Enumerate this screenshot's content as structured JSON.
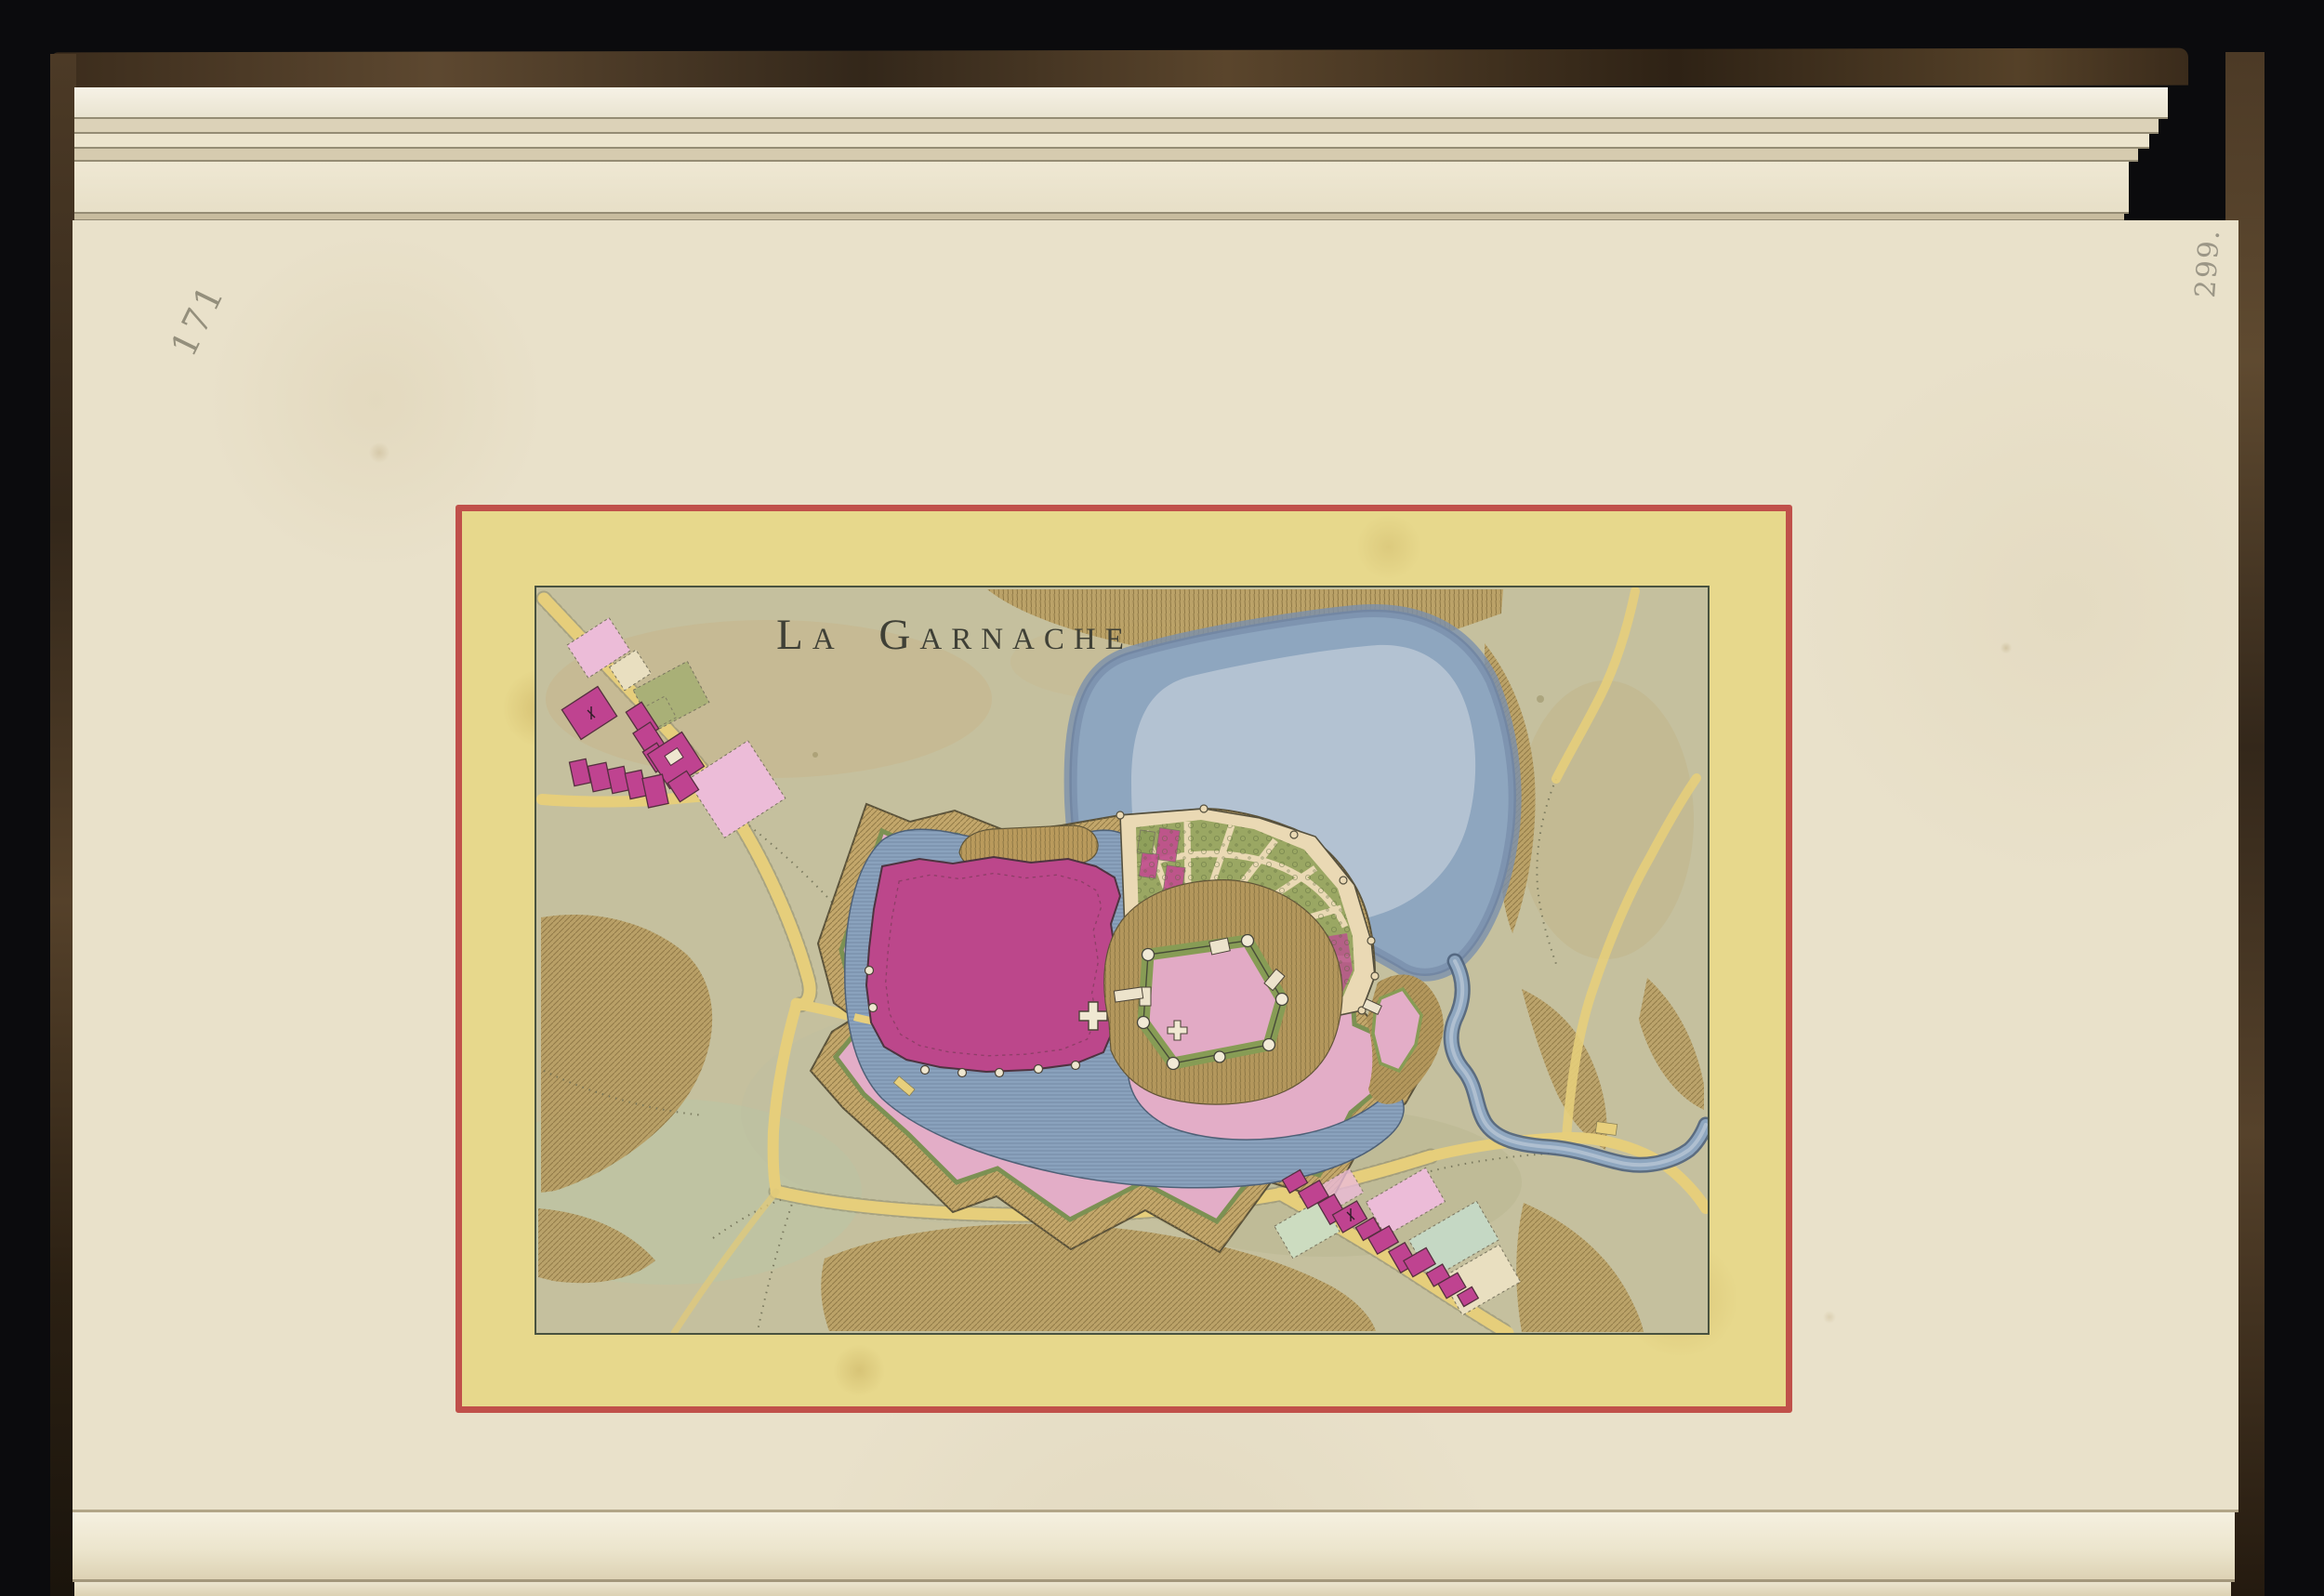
{
  "book": {
    "pencil_page_number": "171",
    "pencil_edge_number": "299."
  },
  "map_plate": {
    "title": "La Garnache",
    "features": {
      "lake": "pond north-east of the fortress",
      "stream": "river leaving the pond toward the right edge",
      "fortified_town": "star-shaped bastioned enceinte with magenta town block and church cross",
      "castle": "pentagonal castle with corner towers and cross",
      "garden": "fan-shaped terraced parterre garden",
      "villages": "hamlets along roads at upper-left and lower-right"
    },
    "colors": {
      "backdrop": "#0b0b0d",
      "leather": "#5a452c",
      "paper": "#e9e1ca",
      "plate_border_red": "#c0504a",
      "plate_band_yellow": "#e7d88c",
      "map_ground": "#c5c09e",
      "water": "#8ea6bf",
      "town_magenta": "#bc478b",
      "glacis_pink": "#e3adc7",
      "rampart_brown": "#c3a76b",
      "garden_green": "#9aa763",
      "road_yellow": "#e6ce7b",
      "pencil": "#86816f"
    }
  }
}
